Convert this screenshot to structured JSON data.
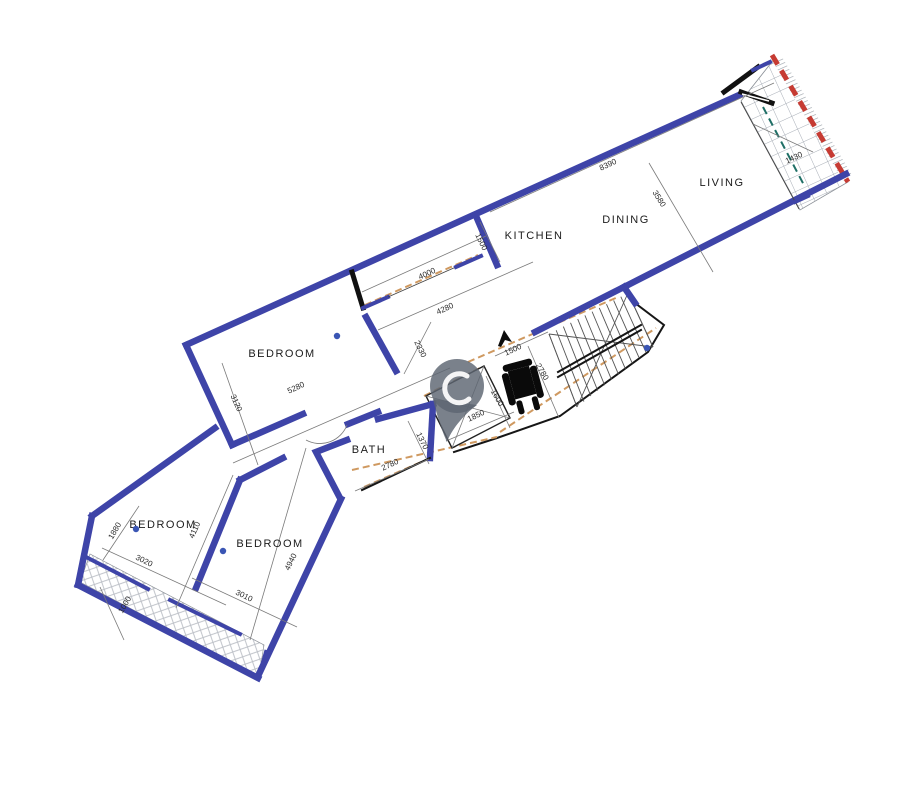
{
  "document": {
    "type": "architectural-floor-plan",
    "description": "Rotated apartment floor plan with living strip, stair core and bedroom wing"
  },
  "colors": {
    "wall_blue": "#3e44a8",
    "boundary_red": "#c63b33",
    "demolition_orange": "#cf9960",
    "axis_teal": "#1f6f66",
    "pin_gray": "#5d6572",
    "marker_blue": "#3a55b4",
    "hatch_gray": "#b9bdc4",
    "tile_gray": "#a7adb6"
  },
  "plan": {
    "room_labels": [
      {
        "label": "LIVING",
        "x": 722,
        "y": 186
      },
      {
        "label": "DINING",
        "x": 626,
        "y": 223
      },
      {
        "label": "KITCHEN",
        "x": 534,
        "y": 239
      },
      {
        "label": "BEDROOM",
        "x": 282,
        "y": 357
      },
      {
        "label": "BATH",
        "x": 369,
        "y": 453
      },
      {
        "label": "BEDROOM",
        "x": 163,
        "y": 528
      },
      {
        "label": "BEDROOM",
        "x": 270,
        "y": 547
      }
    ],
    "dimension_labels": [
      {
        "text": "8390",
        "x": 609,
        "y": 167,
        "rot": -24.5
      },
      {
        "text": "3580",
        "x": 657,
        "y": 200,
        "rot": 58
      },
      {
        "text": "1430",
        "x": 795,
        "y": 160,
        "rot": -24.5
      },
      {
        "text": "4000",
        "x": 428,
        "y": 276,
        "rot": -24.5
      },
      {
        "text": "4280",
        "x": 446,
        "y": 311,
        "rot": -24.5
      },
      {
        "text": "1500",
        "x": 479,
        "y": 243,
        "rot": 64
      },
      {
        "text": "2330",
        "x": 418,
        "y": 350,
        "rot": 64
      },
      {
        "text": "3120",
        "x": 234,
        "y": 404,
        "rot": 66
      },
      {
        "text": "5280",
        "x": 297,
        "y": 390,
        "rot": -24.5
      },
      {
        "text": "1500",
        "x": 514,
        "y": 352,
        "rot": -24.5
      },
      {
        "text": "2780",
        "x": 540,
        "y": 373,
        "rot": 60
      },
      {
        "text": "1600",
        "x": 495,
        "y": 399,
        "rot": 60
      },
      {
        "text": "1850",
        "x": 477,
        "y": 418,
        "rot": -24.5
      },
      {
        "text": "1370",
        "x": 420,
        "y": 442,
        "rot": 64
      },
      {
        "text": "2780",
        "x": 391,
        "y": 467,
        "rot": -24.5
      },
      {
        "text": "1880",
        "x": 117,
        "y": 532,
        "rot": -60
      },
      {
        "text": "3020",
        "x": 143,
        "y": 563,
        "rot": 26
      },
      {
        "text": "4110",
        "x": 197,
        "y": 531,
        "rot": -66
      },
      {
        "text": "4940",
        "x": 293,
        "y": 563,
        "rot": -64
      },
      {
        "text": "3010",
        "x": 243,
        "y": 598,
        "rot": 26
      },
      {
        "text": "1000",
        "x": 127,
        "y": 606,
        "rot": -60
      }
    ],
    "markers": [
      {
        "name": "room-point-marker",
        "x": 337,
        "y": 336
      },
      {
        "name": "room-point-marker",
        "x": 136,
        "y": 529
      },
      {
        "name": "room-point-marker",
        "x": 223,
        "y": 551
      },
      {
        "name": "room-point-marker",
        "x": 647,
        "y": 348
      }
    ],
    "icons": [
      {
        "name": "map-pin-icon",
        "x": 457,
        "y": 400
      },
      {
        "name": "wheelchair-icon",
        "x": 523,
        "y": 386
      },
      {
        "name": "cursor-arrow-icon",
        "x": 504,
        "y": 338
      }
    ]
  }
}
